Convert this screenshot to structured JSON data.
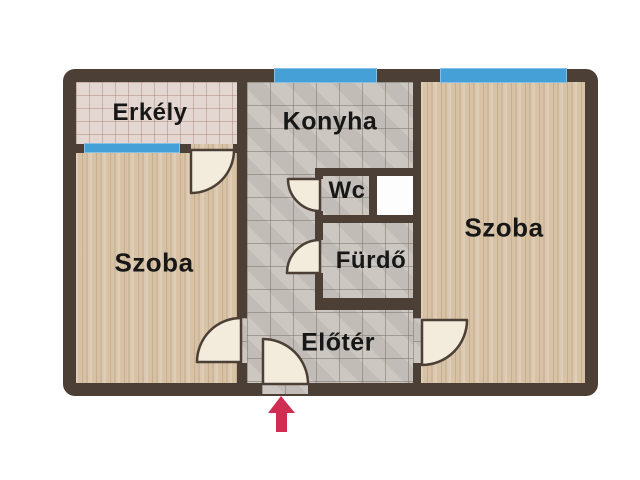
{
  "plan": {
    "type": "apartment-floor-plan",
    "labels": {
      "erkely": "Erkély",
      "konyha": "Konyha",
      "szoba_left": "Szoba",
      "szoba_right": "Szoba",
      "wc": "Wc",
      "furdo": "Fürdő",
      "eloter": "Előtér"
    },
    "entrance": {
      "icon": "entrance-arrow-icon",
      "direction": "up"
    },
    "features": {
      "windows_count": 3,
      "doors_count": 6,
      "shaft": "utility-shaft"
    },
    "colors": {
      "background": "#ffffff",
      "wall": "#4b3f36",
      "window": "#46a0d8",
      "wood_floor": "#d7c2a5",
      "tile_floor": "#cac4bf",
      "balcony_tile": "#e4d6d0",
      "door_leaf": "#f3ecdc",
      "shaft_fill": "#ffffff",
      "arrow": "#d02d52",
      "label_text": "#171717"
    }
  }
}
